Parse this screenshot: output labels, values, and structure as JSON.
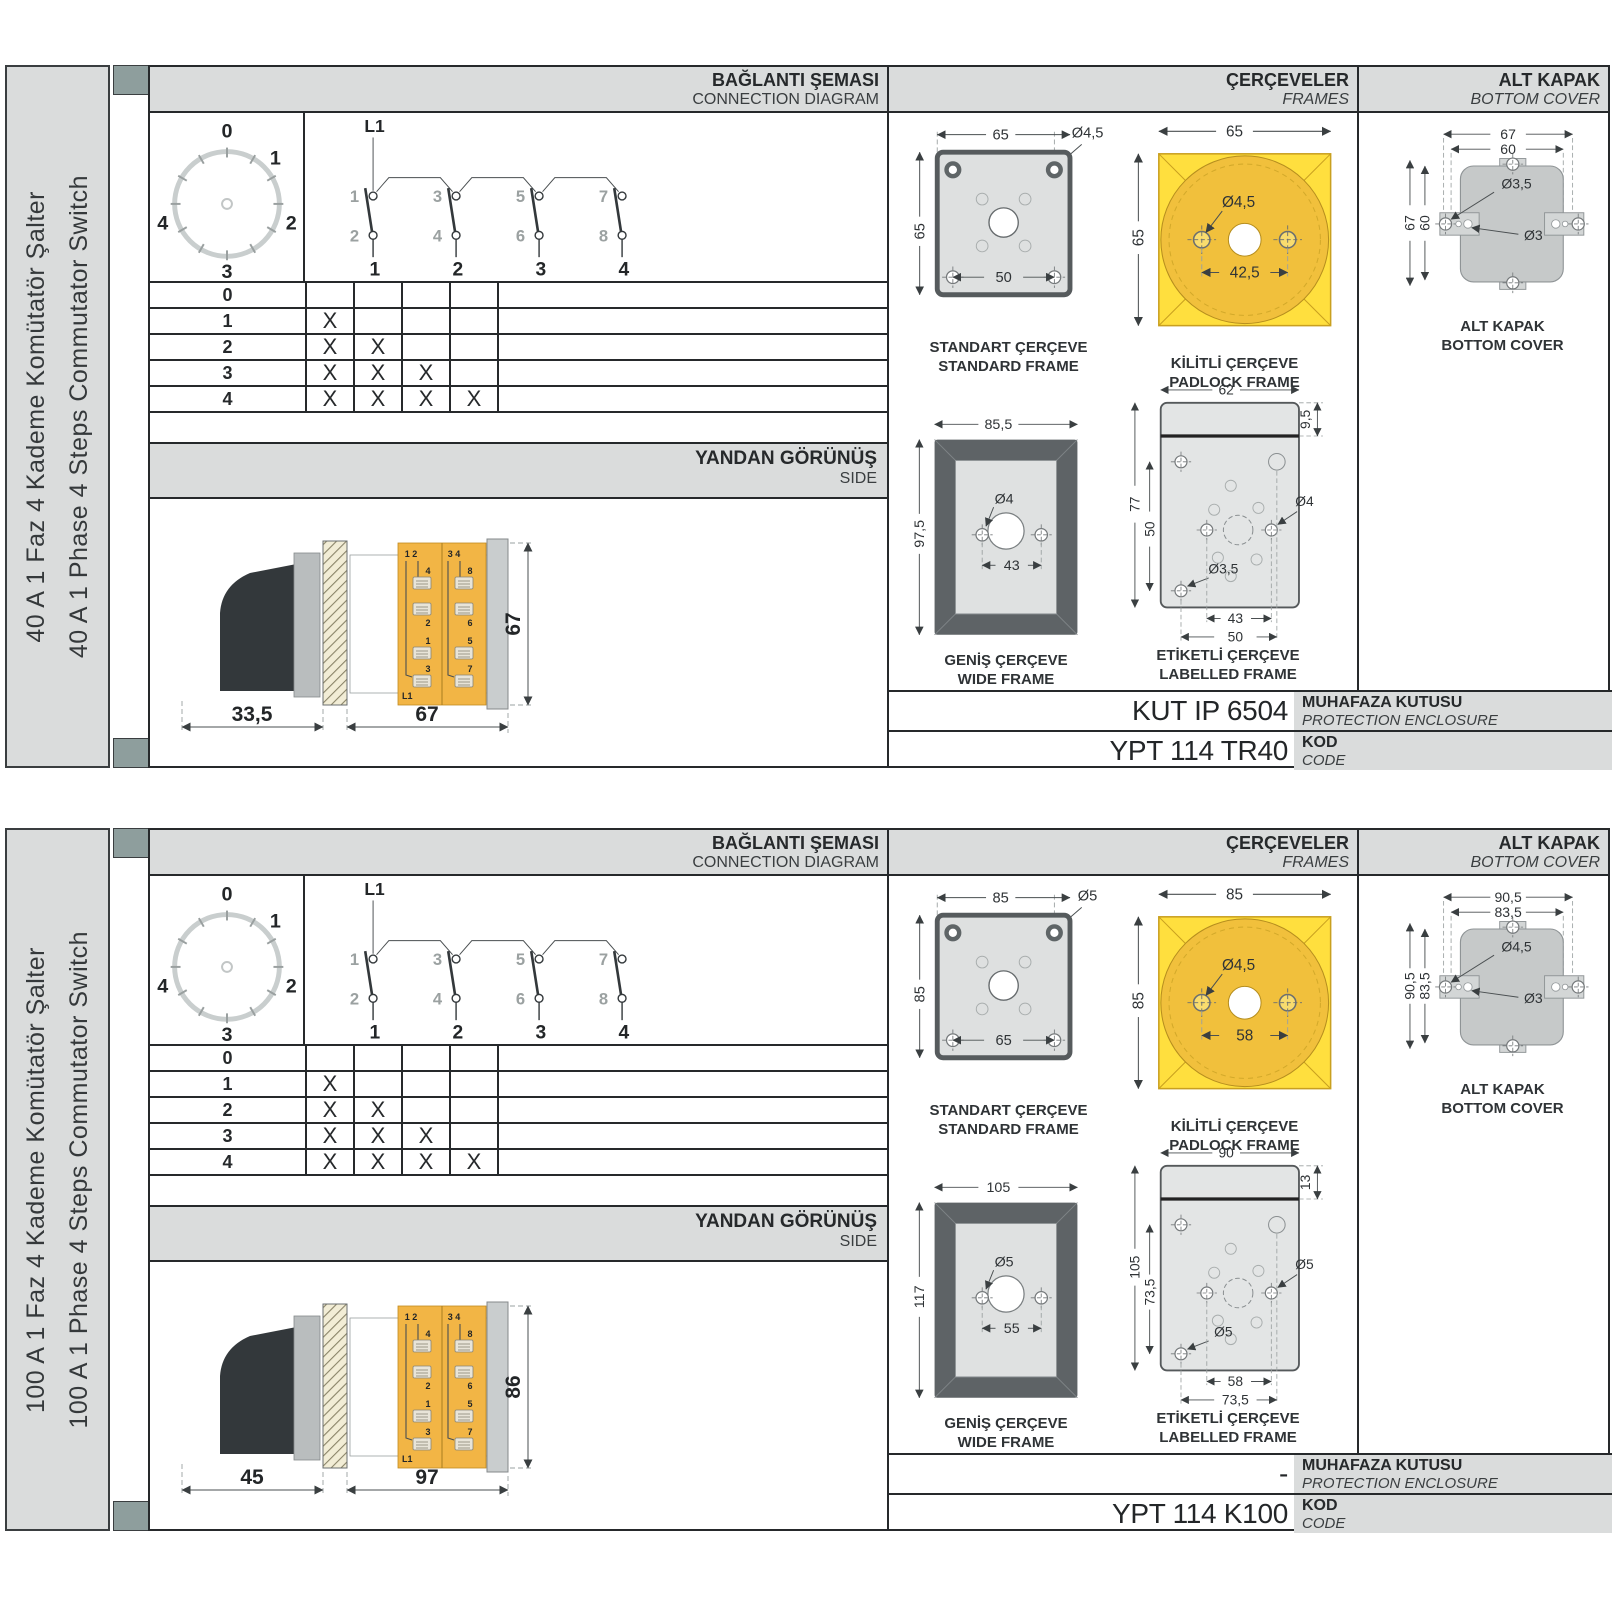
{
  "colors": {
    "accent_yellow": "#FFDF3E",
    "padlock_circle": "#F1C03C",
    "terminal_yellow": "#F2B545",
    "header_gray": "#DADCDC",
    "frame_dark": "#5E6366",
    "cover_gray": "#C6C9C9",
    "binding_square": "#8E9E9D"
  },
  "panels": [
    {
      "sidebar_tr": "40 A 1 Faz 4 Kademe Komütatör Şalter",
      "sidebar_en": "40 A 1 Phase 4 Steps Commutator Switch",
      "hdr": {
        "conn_tr": "BAĞLANTI ŞEMASI",
        "conn_en": "CONNECTION DIAGRAM",
        "frames_tr": "ÇERÇEVELER",
        "frames_en": "FRAMES",
        "cover_tr": "ALT KAPAK",
        "cover_en": "BOTTOM COVER",
        "side_tr": "YANDAN GÖRÜNÜŞ",
        "side_en": "SIDE"
      },
      "dial": {
        "p0": "0",
        "p1": "1",
        "p2": "2",
        "p3": "3",
        "p4": "4"
      },
      "cd": {
        "src": "L1",
        "t1": "1",
        "t3": "3",
        "t5": "5",
        "t7": "7",
        "b2": "2",
        "b4": "4",
        "b6": "6",
        "b8": "8",
        "k1": "1",
        "k2": "2",
        "k3": "3",
        "k4": "4"
      },
      "tbl": {
        "rows": [
          {
            "l": "0",
            "m": [
              "",
              "",
              "",
              ""
            ]
          },
          {
            "l": "1",
            "m": [
              "X",
              "",
              "",
              ""
            ]
          },
          {
            "l": "2",
            "m": [
              "X",
              "X",
              "",
              ""
            ]
          },
          {
            "l": "3",
            "m": [
              "X",
              "X",
              "X",
              ""
            ]
          },
          {
            "l": "4",
            "m": [
              "X",
              "X",
              "X",
              "X"
            ]
          }
        ]
      },
      "side": {
        "d1": "33,5",
        "d2": "67",
        "dh": "67",
        "c1": "1 2",
        "c2": "3 4",
        "ta": "4",
        "tb": "2",
        "tc": "1",
        "td": "3",
        "te": "8",
        "tf": "6",
        "tg": "5",
        "th": "7",
        "l1": "L1"
      },
      "fst": {
        "w": "65",
        "h": "65",
        "hole": "Ø4,5",
        "inner": "50",
        "tr": "STANDART ÇERÇEVE",
        "en": "STANDARD FRAME"
      },
      "fpk": {
        "w": "65",
        "h": "65",
        "hole": "Ø4,5",
        "inner": "42,5",
        "tr": "KİLİTLİ ÇERÇEVE",
        "en": "PADLOCK FRAME"
      },
      "fwd": {
        "w": "85,5",
        "h": "97,5",
        "hole": "Ø4",
        "inner": "43",
        "tr": "GENİŞ ÇERÇEVE",
        "en": "WIDE FRAME"
      },
      "flb": {
        "w": "62",
        "strip": "9,5",
        "h": "77",
        "ih": "50",
        "holeR": "Ø4",
        "holeB": "Ø3,5",
        "d1": "43",
        "d2": "50",
        "tr": "ETİKETLİ ÇERÇEVE",
        "en": "LABELLED FRAME"
      },
      "bc": {
        "w1": "67",
        "w2": "60",
        "h1": "67",
        "h2": "60",
        "holeA": "Ø3,5",
        "holeB": "Ø3",
        "tr": "ALT KAPAK",
        "en": "BOTTOM COVER"
      },
      "enc": {
        "v": "KUT IP 6504",
        "tr": "MUHAFAZA KUTUSU",
        "en": "PROTECTION ENCLOSURE"
      },
      "code": {
        "v": "YPT 114 TR40",
        "tr": "KOD",
        "en": "CODE"
      }
    },
    {
      "sidebar_tr": "100 A 1 Faz 4 Kademe Komütatör Şalter",
      "sidebar_en": "100 A 1 Phase 4 Steps Commutator Switch",
      "hdr": {
        "conn_tr": "BAĞLANTI ŞEMASI",
        "conn_en": "CONNECTION DIAGRAM",
        "frames_tr": "ÇERÇEVELER",
        "frames_en": "FRAMES",
        "cover_tr": "ALT KAPAK",
        "cover_en": "BOTTOM COVER",
        "side_tr": "YANDAN GÖRÜNÜŞ",
        "side_en": "SIDE"
      },
      "dial": {
        "p0": "0",
        "p1": "1",
        "p2": "2",
        "p3": "3",
        "p4": "4"
      },
      "cd": {
        "src": "L1",
        "t1": "1",
        "t3": "3",
        "t5": "5",
        "t7": "7",
        "b2": "2",
        "b4": "4",
        "b6": "6",
        "b8": "8",
        "k1": "1",
        "k2": "2",
        "k3": "3",
        "k4": "4"
      },
      "tbl": {
        "rows": [
          {
            "l": "0",
            "m": [
              "",
              "",
              "",
              ""
            ]
          },
          {
            "l": "1",
            "m": [
              "X",
              "",
              "",
              ""
            ]
          },
          {
            "l": "2",
            "m": [
              "X",
              "X",
              "",
              ""
            ]
          },
          {
            "l": "3",
            "m": [
              "X",
              "X",
              "X",
              ""
            ]
          },
          {
            "l": "4",
            "m": [
              "X",
              "X",
              "X",
              "X"
            ]
          }
        ]
      },
      "side": {
        "d1": "45",
        "d2": "97",
        "dh": "86",
        "c1": "1 2",
        "c2": "3 4",
        "ta": "4",
        "tb": "2",
        "tc": "1",
        "td": "3",
        "te": "8",
        "tf": "6",
        "tg": "5",
        "th": "7",
        "l1": "L1"
      },
      "fst": {
        "w": "85",
        "h": "85",
        "hole": "Ø5",
        "inner": "65",
        "tr": "STANDART ÇERÇEVE",
        "en": "STANDARD FRAME"
      },
      "fpk": {
        "w": "85",
        "h": "85",
        "hole": "Ø4,5",
        "inner": "58",
        "tr": "KİLİTLİ ÇERÇEVE",
        "en": "PADLOCK FRAME"
      },
      "fwd": {
        "w": "105",
        "h": "117",
        "hole": "Ø5",
        "inner": "55",
        "tr": "GENİŞ ÇERÇEVE",
        "en": "WIDE FRAME"
      },
      "flb": {
        "w": "90",
        "strip": "13",
        "h": "105",
        "ih": "73,5",
        "holeR": "Ø5",
        "holeB": "Ø5",
        "d1": "58",
        "d2": "73,5",
        "tr": "ETİKETLİ ÇERÇEVE",
        "en": "LABELLED FRAME"
      },
      "bc": {
        "w1": "90,5",
        "w2": "83,5",
        "h1": "90,5",
        "h2": "83,5",
        "holeA": "Ø4,5",
        "holeB": "Ø3",
        "tr": "ALT KAPAK",
        "en": "BOTTOM COVER"
      },
      "enc": {
        "v": "-",
        "tr": "MUHAFAZA KUTUSU",
        "en": "PROTECTION ENCLOSURE"
      },
      "code": {
        "v": "YPT 114 K100",
        "tr": "KOD",
        "en": "CODE"
      }
    }
  ]
}
